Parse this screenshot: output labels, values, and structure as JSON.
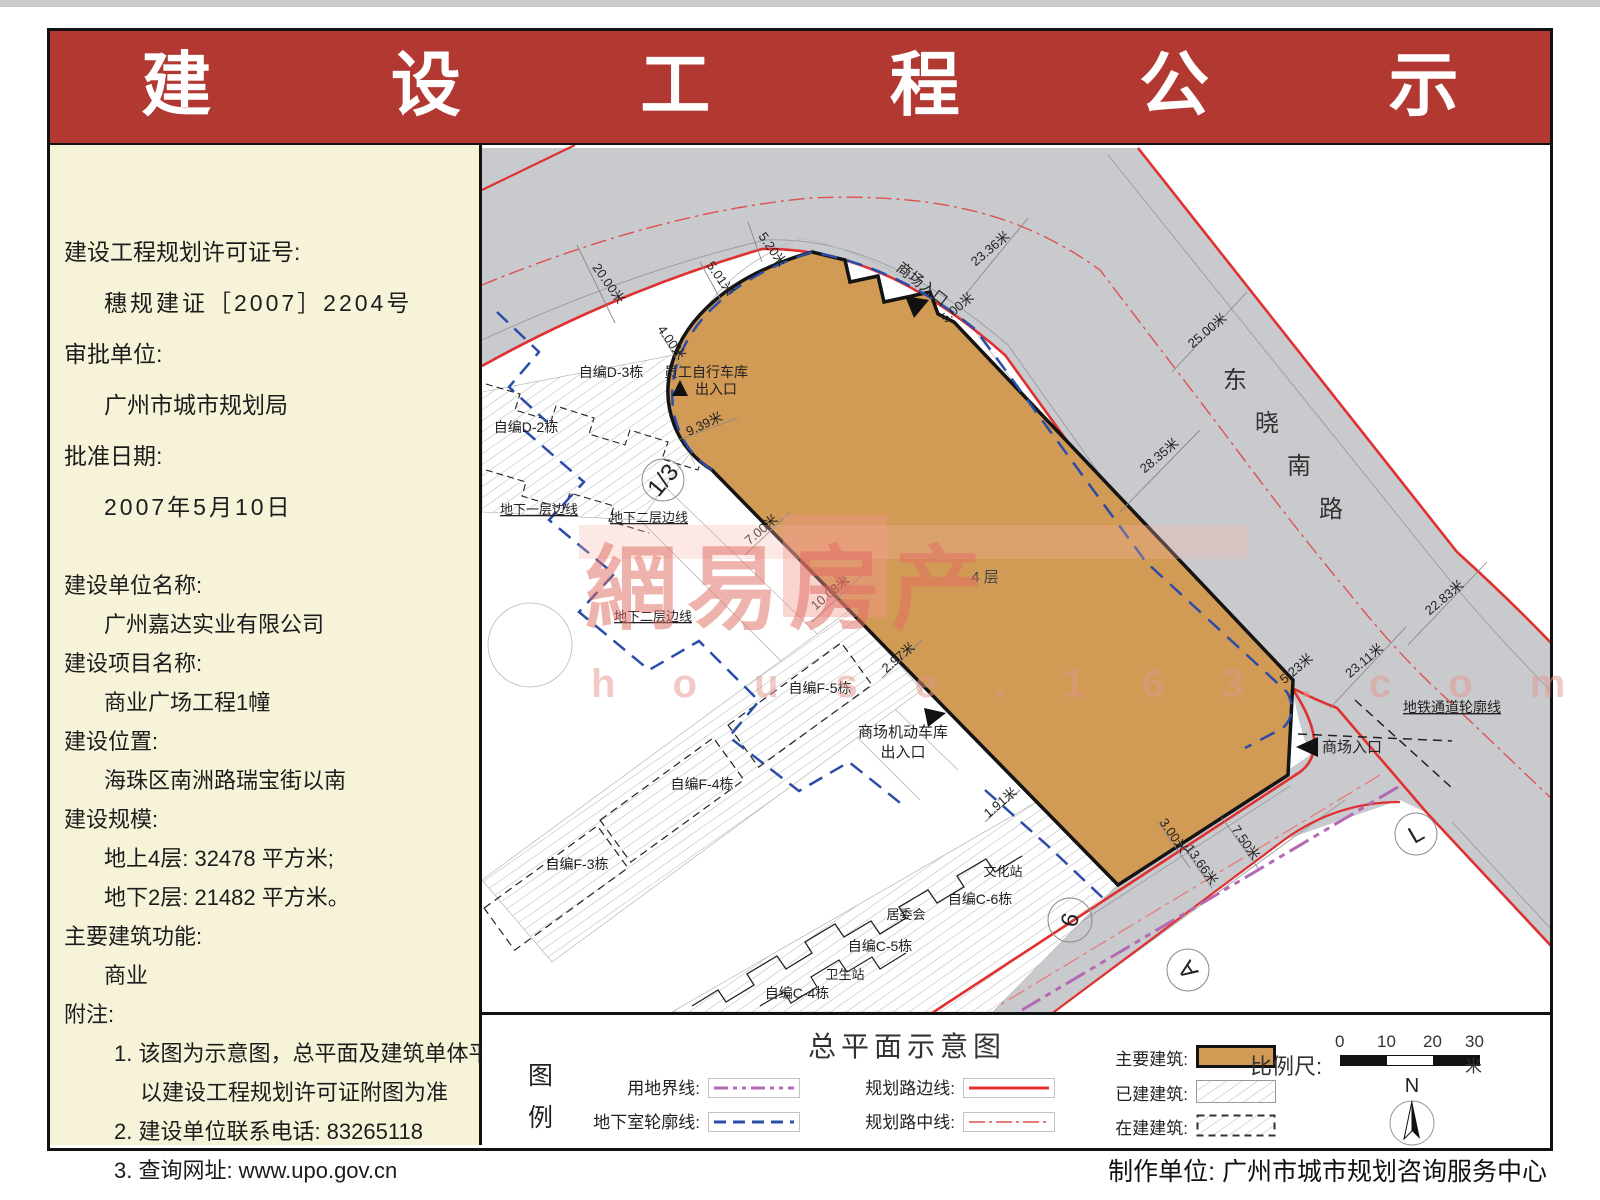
{
  "header": {
    "title": "建 设 工 程 公 示"
  },
  "sidebar": {
    "lines": [
      {
        "t": "建设工程规划许可证号:",
        "b": 1,
        "ind": 0
      },
      {
        "t": "穗规建证［2007］2204号",
        "b": 1,
        "ind": 1,
        "sp": 1
      },
      {
        "t": "审批单位:",
        "b": 1,
        "ind": 0
      },
      {
        "t": "广州市城市规划局",
        "b": 1,
        "ind": 1
      },
      {
        "t": "批准日期:",
        "b": 1,
        "ind": 0
      },
      {
        "t": "2007年5月10日",
        "b": 1,
        "ind": 1,
        "sp": 1
      },
      {
        "t": "建设单位名称:",
        "b": 2,
        "ind": 0,
        "gap": 1
      },
      {
        "t": "广州嘉达实业有限公司",
        "b": 2,
        "ind": 1
      },
      {
        "t": "建设项目名称:",
        "b": 2,
        "ind": 0
      },
      {
        "t": "商业广场工程1幢",
        "b": 2,
        "ind": 1
      },
      {
        "t": "建设位置:",
        "b": 2,
        "ind": 0
      },
      {
        "t": "海珠区南洲路瑞宝街以南",
        "b": 2,
        "ind": 1
      },
      {
        "t": "建设规模:",
        "b": 2,
        "ind": 0
      },
      {
        "t": "地上4层:  32478 平方米;",
        "b": 2,
        "ind": 1
      },
      {
        "t": "地下2层:  21482 平方米。",
        "b": 2,
        "ind": 1
      },
      {
        "t": "主要建筑功能:",
        "b": 2,
        "ind": 0
      },
      {
        "t": "商业",
        "b": 2,
        "ind": 1
      },
      {
        "t": "附注:",
        "b": 2,
        "ind": 0
      },
      {
        "t": "1. 该图为示意图，总平面及建筑单体平面",
        "b": 2,
        "ind": 2
      },
      {
        "t": "以建设工程规划许可证附图为准",
        "b": 2,
        "ind": 3
      },
      {
        "t": "2. 建设单位联系电话:  83265118",
        "b": 2,
        "ind": 2
      },
      {
        "t": "3. 查询网址:  www.upo.gov.cn",
        "b": 2,
        "ind": 2
      }
    ]
  },
  "map": {
    "building_floor_label": "4 层",
    "road_name": "东晓南路",
    "labels": [
      {
        "t": "自编D-2栋",
        "x": 526,
        "y": 432,
        "s": 14
      },
      {
        "t": "自编D-3栋",
        "x": 611,
        "y": 377,
        "s": 14
      },
      {
        "t": "员工自行车库",
        "x": 706,
        "y": 377,
        "s": 14
      },
      {
        "t": "出入口",
        "x": 716,
        "y": 394,
        "s": 14
      },
      {
        "t": "商场入口",
        "x": 919,
        "y": 288,
        "r": 38,
        "s": 15
      },
      {
        "t": "商场入口",
        "x": 1352,
        "y": 752,
        "s": 15
      },
      {
        "t": "商场机动车库",
        "x": 903,
        "y": 737,
        "s": 15
      },
      {
        "t": "出入口",
        "x": 903,
        "y": 757,
        "s": 15
      },
      {
        "t": "地铁通道轮廓线",
        "x": 1452,
        "y": 712,
        "s": 14,
        "u": 1
      },
      {
        "t": "地下一层边线",
        "x": 539,
        "y": 514,
        "s": 13,
        "u": 1
      },
      {
        "t": "地下二层边线",
        "x": 649,
        "y": 522,
        "s": 13,
        "u": 1
      },
      {
        "t": "地下二层边线",
        "x": 653,
        "y": 621,
        "s": 13,
        "u": 1
      },
      {
        "t": "自编F-5栋",
        "x": 820,
        "y": 693,
        "s": 14
      },
      {
        "t": "自编F-4栋",
        "x": 702,
        "y": 789,
        "s": 14
      },
      {
        "t": "自编F-3栋",
        "x": 577,
        "y": 869,
        "s": 14
      },
      {
        "t": "文化站",
        "x": 1003,
        "y": 876,
        "s": 13
      },
      {
        "t": "自编C-6栋",
        "x": 980,
        "y": 904,
        "s": 14
      },
      {
        "t": "居委会",
        "x": 906,
        "y": 919,
        "s": 13
      },
      {
        "t": "自编C-5栋",
        "x": 880,
        "y": 951,
        "s": 14
      },
      {
        "t": "卫生站",
        "x": 845,
        "y": 979,
        "s": 13
      },
      {
        "t": "自编C-4栋",
        "x": 797,
        "y": 998,
        "s": 14
      },
      {
        "t": "4 层",
        "x": 985,
        "y": 582,
        "s": 15,
        "c": "#444"
      },
      {
        "t": "东",
        "x": 1235,
        "y": 388,
        "s": 24,
        "c": "#333"
      },
      {
        "t": "晓",
        "x": 1267,
        "y": 431,
        "s": 24,
        "c": "#333"
      },
      {
        "t": "南",
        "x": 1299,
        "y": 474,
        "s": 24,
        "c": "#333"
      },
      {
        "t": "路",
        "x": 1331,
        "y": 517,
        "s": 24,
        "c": "#333"
      },
      {
        "t": "20.00米",
        "x": 605,
        "y": 286,
        "r": 55,
        "s": 13
      },
      {
        "t": "5.01米",
        "x": 717,
        "y": 281,
        "r": 55,
        "s": 13
      },
      {
        "t": "5.20米",
        "x": 769,
        "y": 252,
        "r": 55,
        "s": 13
      },
      {
        "t": "4.00米",
        "x": 668,
        "y": 345,
        "r": 55,
        "s": 13
      },
      {
        "t": "9.39米",
        "x": 706,
        "y": 428,
        "r": -25,
        "s": 13
      },
      {
        "t": "23.36米",
        "x": 993,
        "y": 252,
        "r": -40,
        "s": 13
      },
      {
        "t": "5.00米",
        "x": 960,
        "y": 311,
        "r": -40,
        "s": 13
      },
      {
        "t": "25.00米",
        "x": 1210,
        "y": 334,
        "r": -40,
        "s": 13
      },
      {
        "t": "28.35米",
        "x": 1162,
        "y": 459,
        "r": -40,
        "s": 13
      },
      {
        "t": "22.83米",
        "x": 1447,
        "y": 601,
        "r": -40,
        "s": 13
      },
      {
        "t": "23.11米",
        "x": 1367,
        "y": 664,
        "r": -40,
        "s": 13
      },
      {
        "t": "5.23米",
        "x": 1299,
        "y": 672,
        "r": -40,
        "s": 13
      },
      {
        "t": "7.00米",
        "x": 764,
        "y": 533,
        "r": -40,
        "s": 13
      },
      {
        "t": "10.08米",
        "x": 833,
        "y": 596,
        "r": -40,
        "s": 13
      },
      {
        "t": "2.97米",
        "x": 901,
        "y": 661,
        "r": -40,
        "s": 13
      },
      {
        "t": "1.91米",
        "x": 1003,
        "y": 806,
        "r": -40,
        "s": 13
      },
      {
        "t": "3.00米",
        "x": 1170,
        "y": 838,
        "r": 55,
        "s": 13
      },
      {
        "t": "7.50米",
        "x": 1242,
        "y": 845,
        "r": 55,
        "s": 13
      },
      {
        "t": "13.66米",
        "x": 1198,
        "y": 867,
        "r": 55,
        "s": 13
      }
    ],
    "circles": [
      {
        "t": "1/3",
        "x": 663,
        "y": 480,
        "r": 21,
        "rot": -50
      },
      {
        "t": "6",
        "x": 1070,
        "y": 920,
        "r": 22,
        "rot": -75
      },
      {
        "t": "L",
        "x": 1416,
        "y": 834,
        "r": 21,
        "rot": -30
      },
      {
        "t": "A",
        "x": 1188,
        "y": 970,
        "r": 21,
        "rot": -125
      }
    ],
    "watermark": {
      "main": "網易房产",
      "sub": "h o u s e . 1 6 3 . c o m"
    }
  },
  "legend": {
    "title": "总平面示意图",
    "key_label": "图例",
    "line_items": [
      {
        "label": "用地界线:"
      },
      {
        "label": "地下室轮廓线:"
      },
      {
        "label": "规划路边线:"
      },
      {
        "label": "规划路中线:"
      }
    ],
    "area_items": [
      {
        "label": "主要建筑:"
      },
      {
        "label": "已建建筑:"
      },
      {
        "label": "在建建筑:"
      }
    ],
    "scale_label": "比例尺:",
    "scale_ticks": [
      "0",
      "10",
      "20",
      "30米"
    ],
    "north_label": "N"
  },
  "page": {
    "footer": "制作单位: 广州市城市规划咨询服务中心"
  },
  "colors": {
    "banner_red": "#b23832",
    "sidebar_cream": "#f6f3d9",
    "building_tan": "#d19a55",
    "road_gray": "#c9cacd",
    "road_edge_red": "#e03030",
    "road_center_pink": "#e87a7a",
    "basement_blue": "#2b4da8",
    "land_boundary_purple": "#b469b4"
  }
}
